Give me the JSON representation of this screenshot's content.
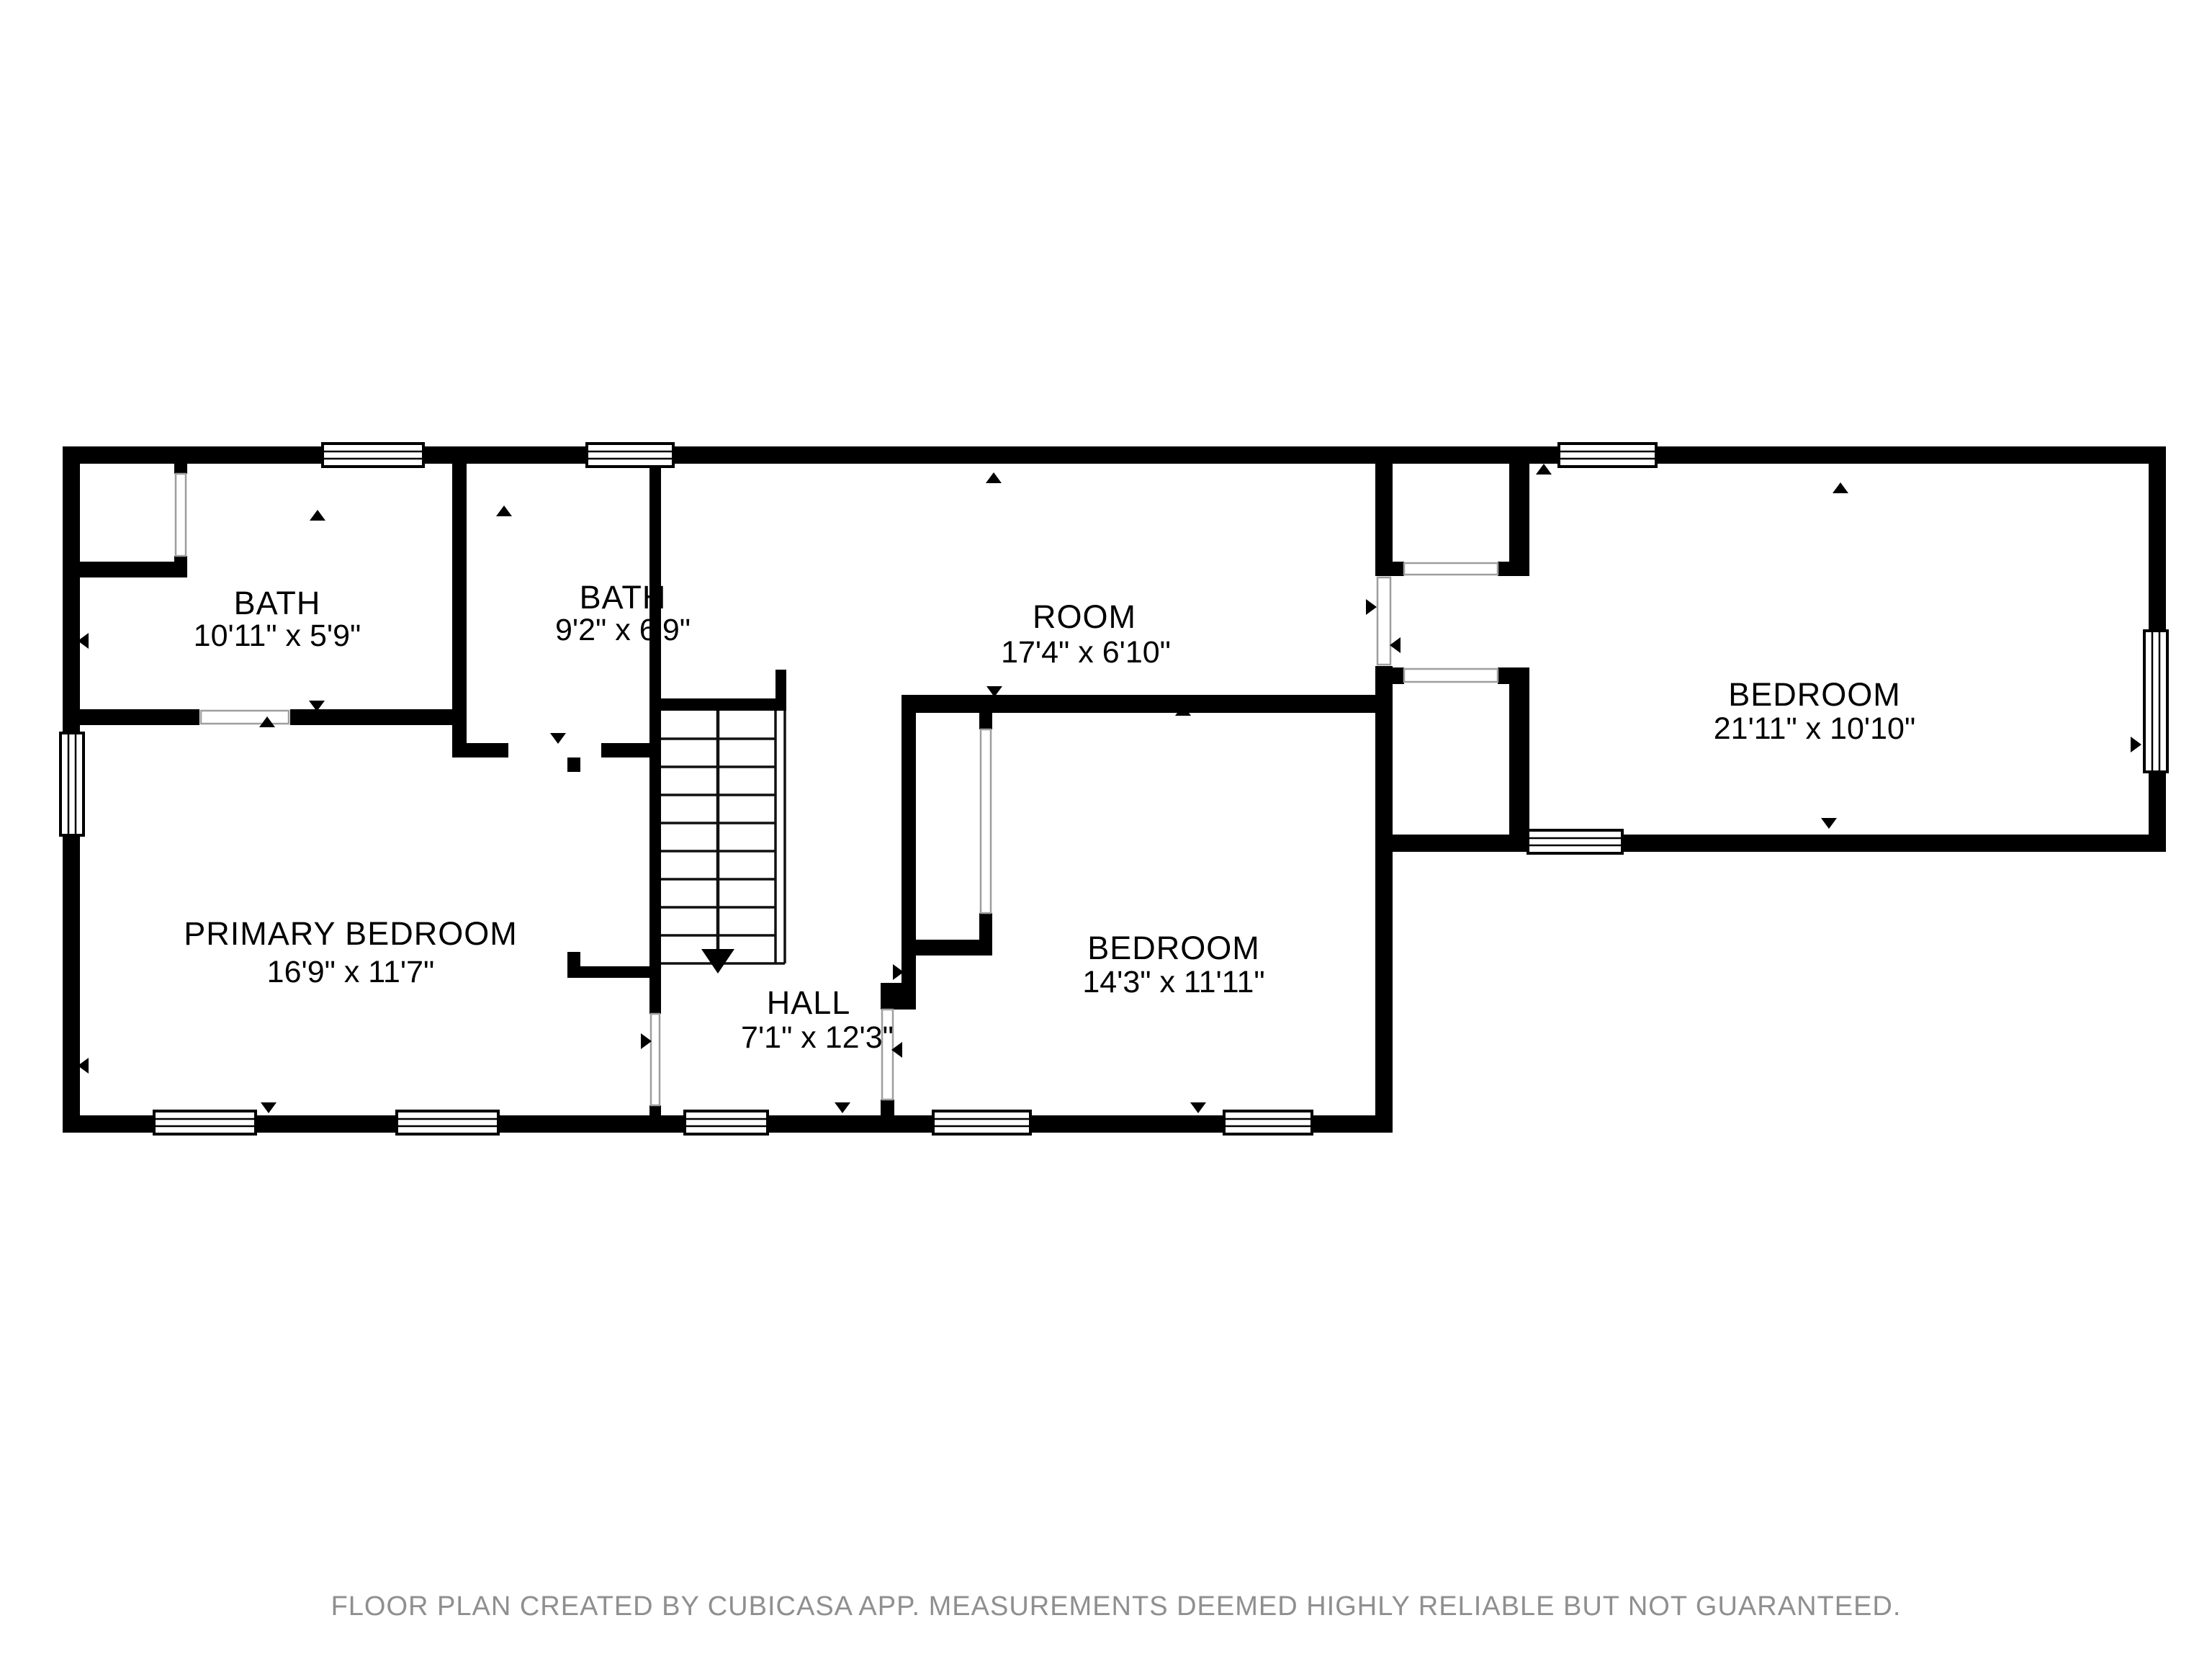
{
  "colors": {
    "wall": "#000000",
    "floor": "#ffffff",
    "opening": "#9e9e9e",
    "footer": "#8f8f8f",
    "label": "#000000"
  },
  "rooms": [
    {
      "name": "BATH",
      "dimensions": "10'11\" x 5'9\""
    },
    {
      "name": "BATH",
      "dimensions": "9'2\" x 6'9\""
    },
    {
      "name": "ROOM",
      "dimensions": "17'4\" x 6'10\""
    },
    {
      "name": "BEDROOM",
      "dimensions": "21'11\" x 10'10\""
    },
    {
      "name": "PRIMARY BEDROOM",
      "dimensions": "16'9\" x 11'7\""
    },
    {
      "name": "HALL",
      "dimensions": "7'1\" x 12'3\""
    },
    {
      "name": "BEDROOM",
      "dimensions": "14'3\" x 11'11\""
    }
  ],
  "footer": {
    "text": "FLOOR PLAN CREATED BY CUBICASA APP. MEASUREMENTS DEEMED HIGHLY RELIABLE BUT NOT GUARANTEED."
  }
}
